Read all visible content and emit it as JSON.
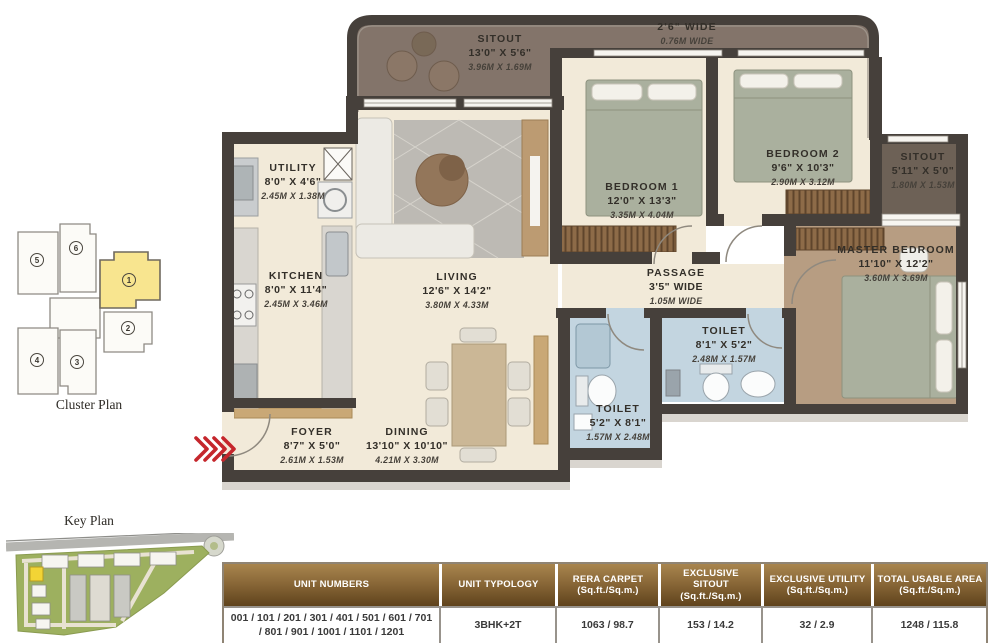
{
  "captions": {
    "cluster_plan": "Cluster Plan",
    "key_plan": "Key Plan"
  },
  "cluster_plan": {
    "units": [
      {
        "num": "1",
        "highlighted": true
      },
      {
        "num": "2",
        "highlighted": false
      },
      {
        "num": "3",
        "highlighted": false
      },
      {
        "num": "4",
        "highlighted": false
      },
      {
        "num": "5",
        "highlighted": false
      },
      {
        "num": "6",
        "highlighted": false
      }
    ]
  },
  "floor_plan": {
    "rooms": [
      {
        "id": "sitout_top",
        "name": "SITOUT",
        "imperial": "13'0\" X 5'6\"",
        "metric": "3.96M X 1.69M"
      },
      {
        "id": "walkway",
        "name": "2'6\" WIDE",
        "metric": "0.76M WIDE"
      },
      {
        "id": "utility",
        "name": "UTILITY",
        "imperial": "8'0\" X 4'6\"",
        "metric": "2.45M X 1.38M"
      },
      {
        "id": "kitchen",
        "name": "KITCHEN",
        "imperial": "8'0\" X 11'4\"",
        "metric": "2.45M X 3.46M"
      },
      {
        "id": "living",
        "name": "LIVING",
        "imperial": "12'6\" X 14'2\"",
        "metric": "3.80M X 4.33M"
      },
      {
        "id": "bedroom1",
        "name": "BEDROOM 1",
        "imperial": "12'0\" X 13'3\"",
        "metric": "3.35M X 4.04M"
      },
      {
        "id": "bedroom2",
        "name": "BEDROOM 2",
        "imperial": "9'6\" X 10'3\"",
        "metric": "2.90M X 3.12M"
      },
      {
        "id": "sitout_right",
        "name": "SITOUT",
        "imperial": "5'11\" X 5'0\"",
        "metric": "1.80M X 1.53M"
      },
      {
        "id": "master",
        "name": "MASTER BEDROOM",
        "imperial": "11'10\" X 12'2\"",
        "metric": "3.60M X 3.69M"
      },
      {
        "id": "passage",
        "name": "PASSAGE",
        "imperial": "3'5\" WIDE",
        "metric": "1.05M WIDE"
      },
      {
        "id": "toilet_right",
        "name": "TOILET",
        "imperial": "8'1\" X 5'2\"",
        "metric": "2.48M X 1.57M"
      },
      {
        "id": "toilet_bottom",
        "name": "TOILET",
        "imperial": "5'2\" X 8'1\"",
        "metric": "1.57M X 2.48M"
      },
      {
        "id": "foyer",
        "name": "FOYER",
        "imperial": "8'7\" X 5'0\"",
        "metric": "2.61M X 1.53M"
      },
      {
        "id": "dining",
        "name": "DINING",
        "imperial": "13'10\" X 10'10\"",
        "metric": "4.21M X 3.30M"
      }
    ]
  },
  "table": {
    "columns": [
      {
        "header": "UNIT NUMBERS",
        "value": "001 / 101 / 201 / 301 / 401 / 501 / 601 / 701 / 801 / 901 / 1001 / 1101 / 1201"
      },
      {
        "header": "UNIT TYPOLOGY",
        "value": "3BHK+2T"
      },
      {
        "header": "RERA CARPET (Sq.ft./Sq.m.)",
        "value": "1063 / 98.7"
      },
      {
        "header": "EXCLUSIVE SITOUT (Sq.ft./Sq.m.)",
        "value": "153 / 14.2"
      },
      {
        "header": "EXCLUSIVE UTILITY (Sq.ft./Sq.m.)",
        "value": "32 / 2.9"
      },
      {
        "header": "TOTAL USABLE AREA (Sq.ft./Sq.m.)",
        "value": "1248 / 115.8"
      }
    ]
  },
  "colors": {
    "wall": "#46403b",
    "floor": "#f2ead9",
    "balcony_floor": "#83746a",
    "master_floor": "#b79d82",
    "toilet_floor": "#c3d5e0",
    "entry_arrow_red": "#c5262c",
    "cluster_highlight": "#f8e58f",
    "table_header_gold": "#8a6838"
  }
}
